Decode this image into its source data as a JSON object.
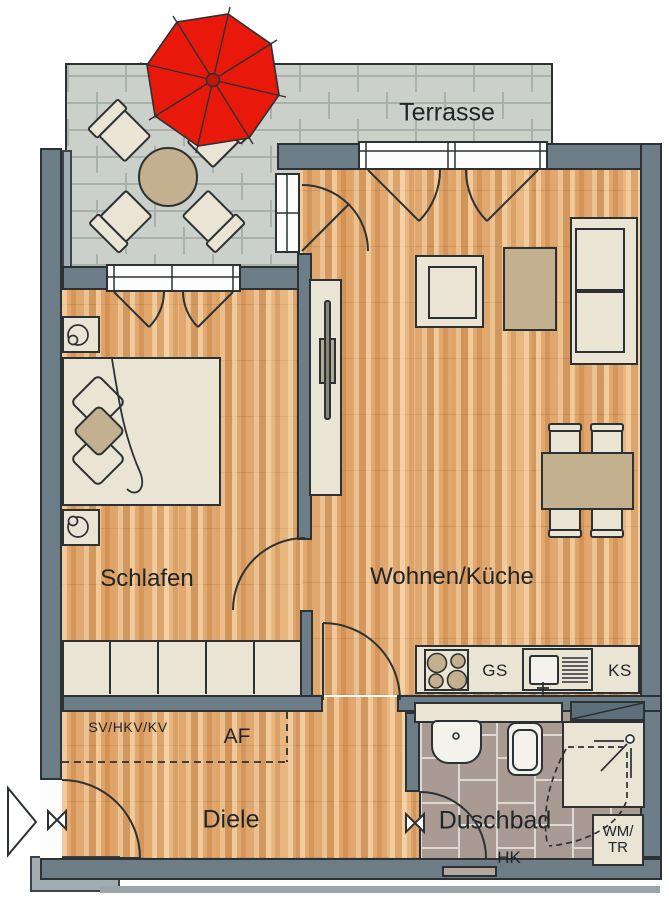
{
  "plan": {
    "type": "apartment-floor-plan",
    "labels": {
      "terrasse": "Terrasse",
      "schlafen": "Schlafen",
      "wohnen_kueche": "Wohnen/Küche",
      "diele": "Diele",
      "duschbad": "Duschbad",
      "sv_hkv_kv": "SV/HKV/KV",
      "af": "AF",
      "gs": "GS",
      "ks": "KS",
      "hk": "HK",
      "wm_line1": "WM/",
      "wm_line2": "TR"
    },
    "colors": {
      "wall": "#6d7d87",
      "wood_floor": "#e0a76e",
      "terrace_tile": "#cbd0ca",
      "bath_tile": "#a99b94",
      "furniture": "#eae4d4",
      "table_tan": "#c2b08e",
      "umbrella_red": "#e8190a",
      "outline": "#2c3133"
    }
  }
}
